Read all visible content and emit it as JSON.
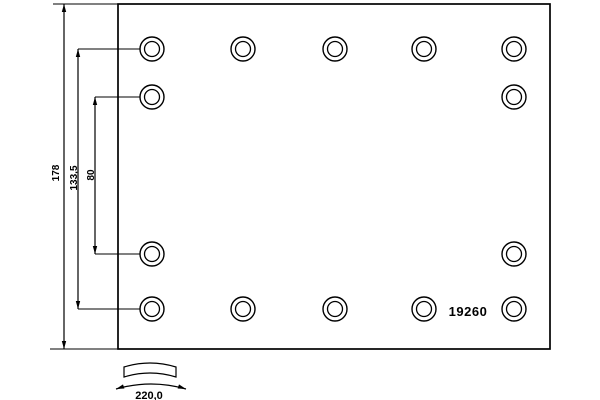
{
  "colors": {
    "background": "#ffffff",
    "line": "#000000"
  },
  "drawing": {
    "part_number": "19260",
    "plate": {
      "x": 118,
      "y": 4,
      "width": 432,
      "height": 345
    },
    "holes": {
      "outer_radius": 12,
      "inner_radius": 7.5,
      "columns_x": [
        152,
        243,
        335,
        424,
        514
      ],
      "rows_y": [
        49,
        97,
        254,
        309
      ],
      "row_columns": [
        [
          0,
          1,
          2,
          3,
          4
        ],
        [
          0,
          4
        ],
        [
          0,
          4
        ],
        [
          0,
          1,
          2,
          3,
          4
        ]
      ]
    },
    "vertical_dimensions": [
      {
        "label": "178",
        "line_x": 64,
        "y1": 4,
        "y2": 349,
        "extensions": [
          [
            53,
            4,
            118,
            4
          ],
          [
            50,
            349,
            118,
            349
          ]
        ]
      },
      {
        "label": "133,5",
        "line_x": 78,
        "y1": 49,
        "y2": 309,
        "extensions": [
          [
            78,
            49,
            140,
            49
          ],
          [
            78,
            309,
            140,
            309
          ]
        ]
      },
      {
        "label": "80",
        "line_x": 95,
        "y1": 97,
        "y2": 254,
        "extensions": [
          [
            95,
            97,
            140,
            97
          ],
          [
            95,
            254,
            140,
            254
          ]
        ]
      }
    ],
    "arc_dimension": {
      "label": "220,0",
      "band": {
        "x1": 124,
        "x2": 176,
        "top_y": 367,
        "thickness": 10,
        "rise": 8
      },
      "arrow": {
        "x1": 116,
        "x2": 186,
        "y": 389,
        "peak_y": 379
      }
    }
  }
}
